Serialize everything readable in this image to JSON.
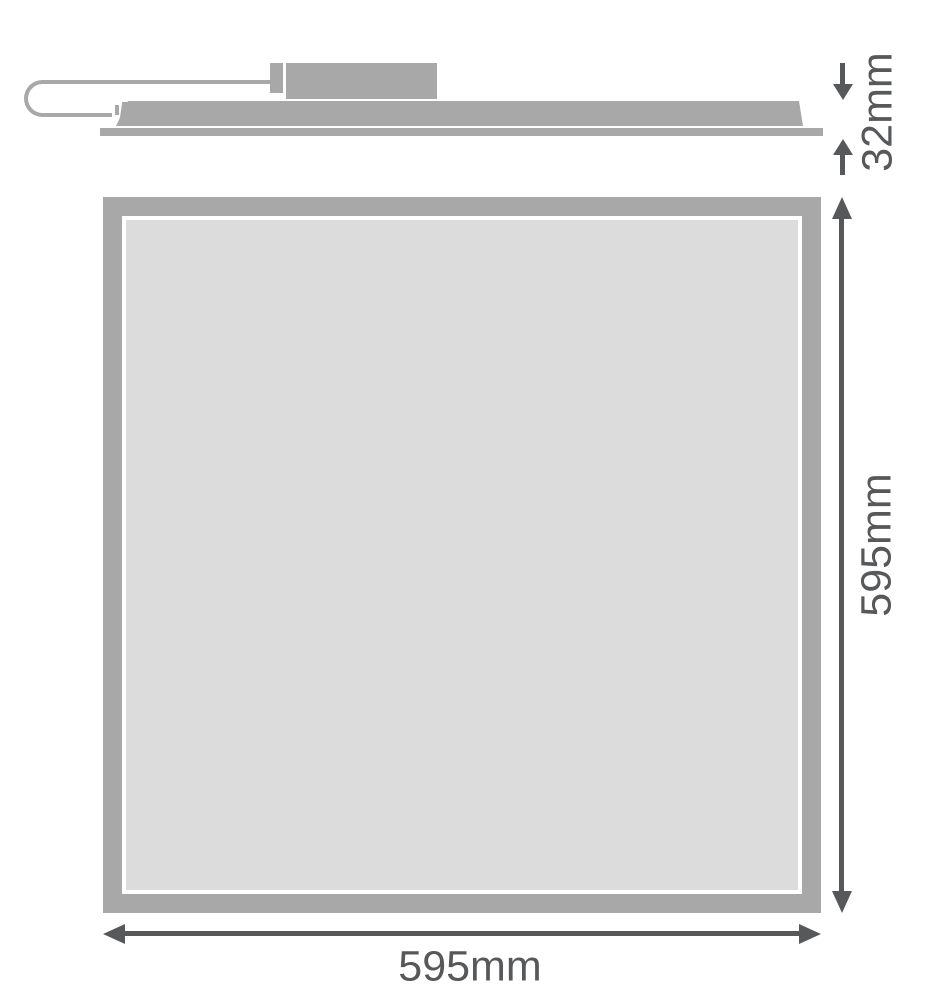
{
  "colors": {
    "fixture_gray": "#a8a8a8",
    "panel_fill": "#dcdcdc",
    "dimension_color": "#57585a",
    "page_bg": "#ffffff"
  },
  "drawing": {
    "type": "product-dimension-diagram",
    "views": {
      "side_view": {
        "parts": [
          "power-cable-loop",
          "cable-connector",
          "driver-box",
          "panel-body-profile",
          "panel-frame-flange"
        ]
      },
      "front_view": {
        "parts": [
          "panel-frame",
          "panel-diffuser"
        ]
      }
    },
    "icons": {
      "thickness_top": "arrow-down",
      "thickness_bottom": "arrow-up",
      "height": "double-headed-vertical-arrow",
      "width": "double-headed-horizontal-arrow"
    }
  },
  "dimensions": {
    "thickness": {
      "label": "32mm",
      "orientation": "vertical-rotated"
    },
    "height": {
      "label": "595mm",
      "orientation": "vertical-rotated"
    },
    "width": {
      "label": "595mm",
      "orientation": "horizontal"
    }
  }
}
